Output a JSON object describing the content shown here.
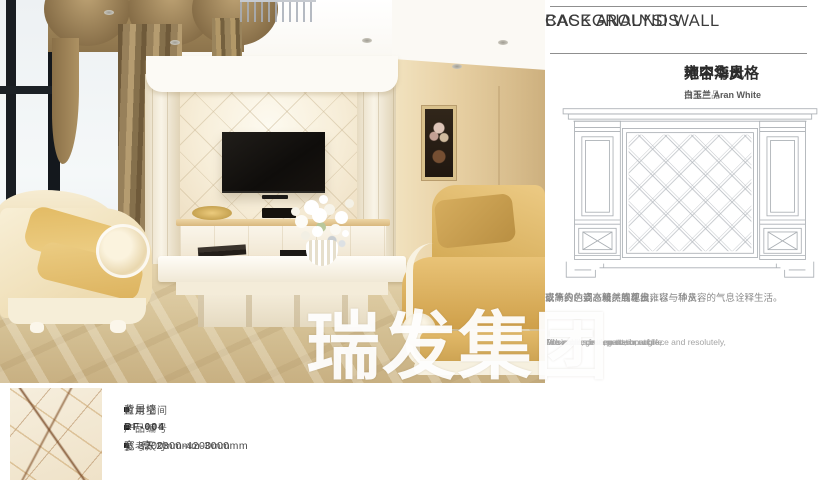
{
  "panel": {
    "header_line1": "BACKGROUND WALL",
    "header_line2": "CASE ANALYSIS",
    "title_style": "地中海风格",
    "title_sep": " - ",
    "title_theme": "雍容华贵",
    "subtitle_prefix": "推荐产品 - ",
    "subtitle_product": "白玉兰 Aran White",
    "desc_cn": [
      "以高贵的姿态毅然展现出雍容与华贵，",
      "豪华的色调、精美的花纹，",
      "或简约、或高雅、或尊贵，以一种从容的气息诠释生活。"
    ],
    "desc_en": [
      "The noble gesture to show grace and resolutely,",
      "A luxurious hue, pattern, etc,",
      "Or simple, or elegant, or noble,",
      "with a calm interpretation of life."
    ]
  },
  "photo": {
    "watermark": "瑞发集团"
  },
  "product_info": {
    "rows": [
      {
        "label": "应用空间",
        "value": "背景墙"
      },
      {
        "label": "产品编号",
        "value": "RF-004"
      },
      {
        "label": "参考尺寸",
        "value": "宽 3200mm-4200mm",
        "value2": "高 2300mm-3000mm"
      }
    ]
  },
  "colors": {
    "header_text": "#3c3c3c",
    "body_gray": "#8b8b8b",
    "drawing_line": "#a9aeb3",
    "watermark": "#ffffff"
  }
}
